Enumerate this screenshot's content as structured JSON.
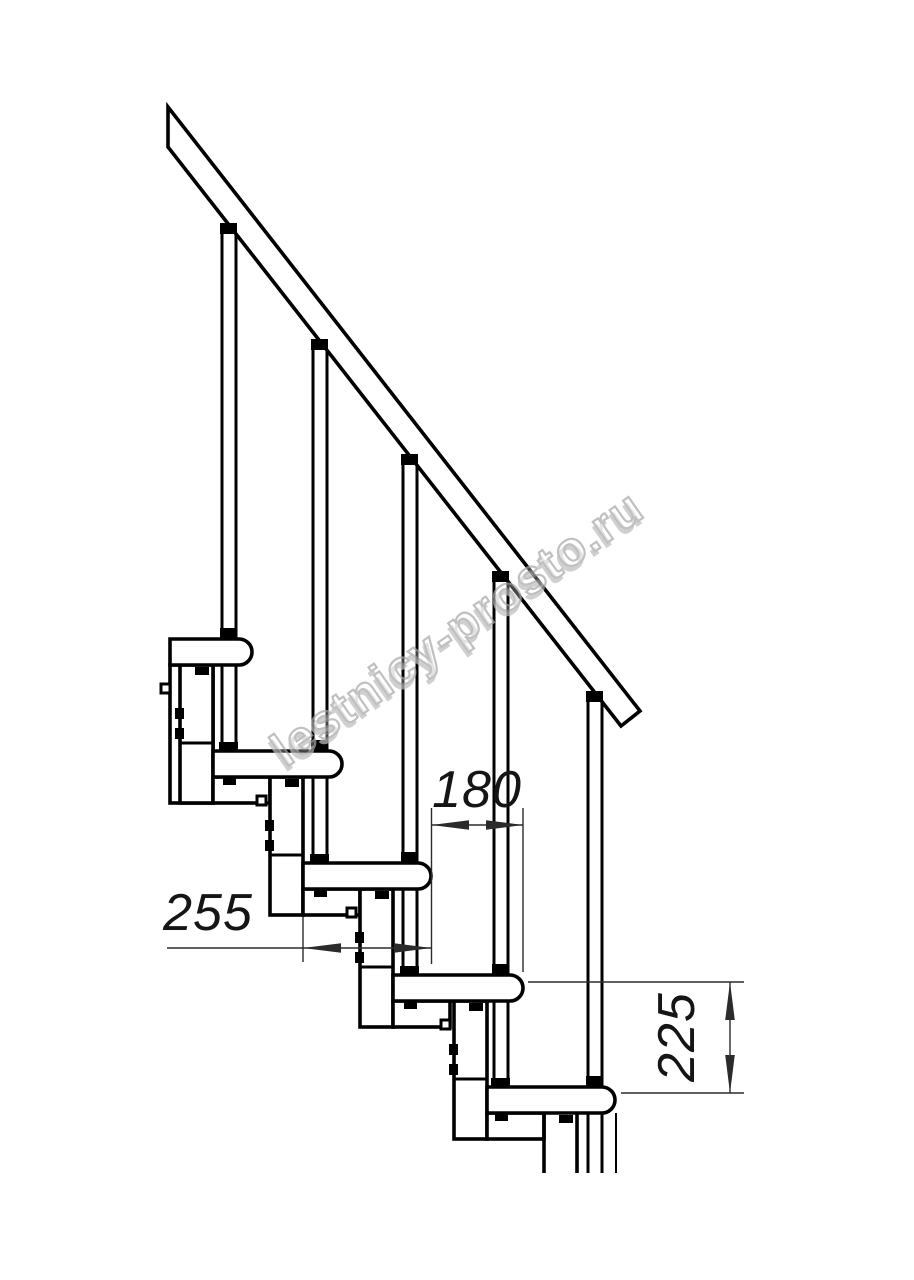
{
  "drawing": {
    "title": "modular-staircase-side-view",
    "dimensions": [
      {
        "id": "dim-180",
        "label": "180",
        "orientation": "horizontal"
      },
      {
        "id": "dim-255",
        "label": "255",
        "orientation": "horizontal"
      },
      {
        "id": "dim-225",
        "label": "225",
        "orientation": "vertical"
      }
    ],
    "watermark": {
      "text": "lestnicy-prosto.ru"
    },
    "colors": {
      "line": "#000000",
      "thin": "#2b2b2b",
      "bg": "#ffffff",
      "wm_stroke": "#a9a9a9",
      "wm_shadow": "#bfbfbf"
    }
  }
}
